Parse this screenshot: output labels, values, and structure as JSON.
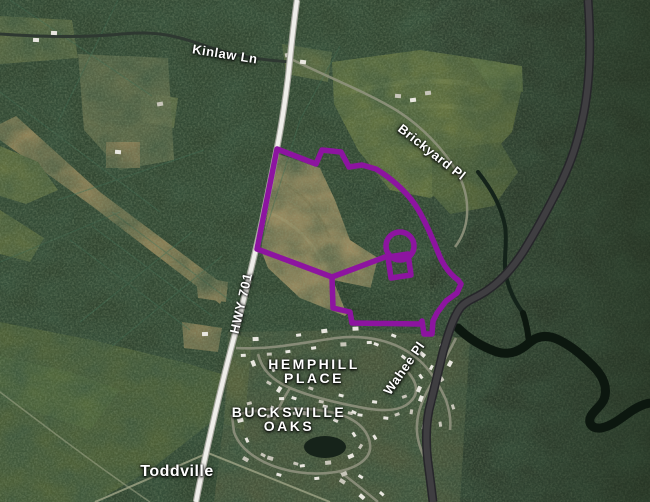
{
  "map": {
    "labels": {
      "kinlaw": "Kinlaw Ln",
      "brickyard": "Brickyard Pl",
      "hwy701": "HWY 701",
      "hemphill_line1": "HEMPHILL",
      "hemphill_line2": "PLACE",
      "bucksville_line1": "BUCKSVILLE",
      "bucksville_line2": "OAKS",
      "wahee": "Wahee Pl",
      "toddville": "Toddville"
    },
    "colors": {
      "parcel_boundary": "#8D14A0",
      "highway_fill": "#EFEEEA",
      "highway_casing": "#A9A9A1",
      "dark_road": "#3F3E41",
      "river": "#0C170F",
      "label_text": "#FFFFFF"
    }
  }
}
